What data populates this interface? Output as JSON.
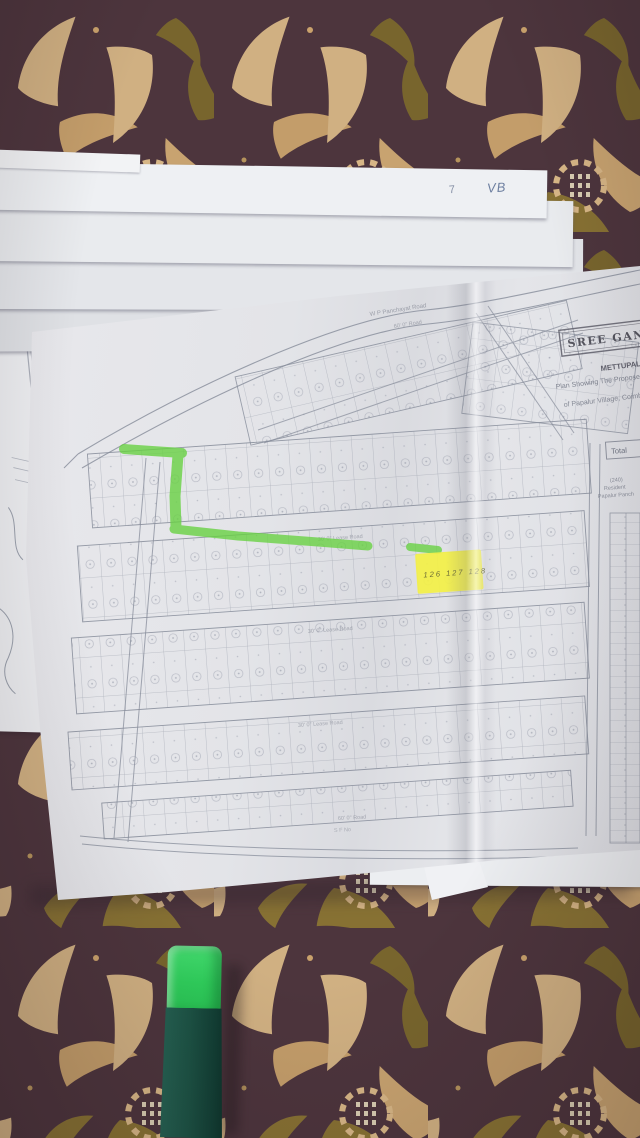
{
  "colors": {
    "fabric_dark": "#4d353d",
    "fabric_tan": "#d7b686",
    "fabric_olive": "#8d7832",
    "paper": "#e7e8ec",
    "map_line": "#8f95a2",
    "highlighter_green": "#66d140",
    "note_yellow": "#f3f046",
    "marker_cap_green": "#35d162",
    "marker_body_green": "#1c5244",
    "ink_blue": "#6d7fa0"
  },
  "papers": {
    "handwritten_mark": "7",
    "handwritten_initials": "VB"
  },
  "map": {
    "title": "SREE GANA",
    "subtitle": "METTUPALAYAM",
    "caption_line1": "Plan Showing The Proposed Lay",
    "caption_line2": "of Papalur Village, Coimb",
    "top_road_label": "W P Panchayat Road",
    "top_road_sub": "60' 0\" Road",
    "road_labels": [
      "30' 0\" Lease Road",
      "30' 0\" Lease Road",
      "30' 0\" Lease Road"
    ],
    "bottom_line1": "60' 0\" Road",
    "bottom_line2": "S F No",
    "total_label": "Total",
    "note_lines": [
      "(240)",
      "Resident",
      "Papalur Panch"
    ]
  },
  "sticky_note": {
    "numbers": "126 127 128"
  }
}
